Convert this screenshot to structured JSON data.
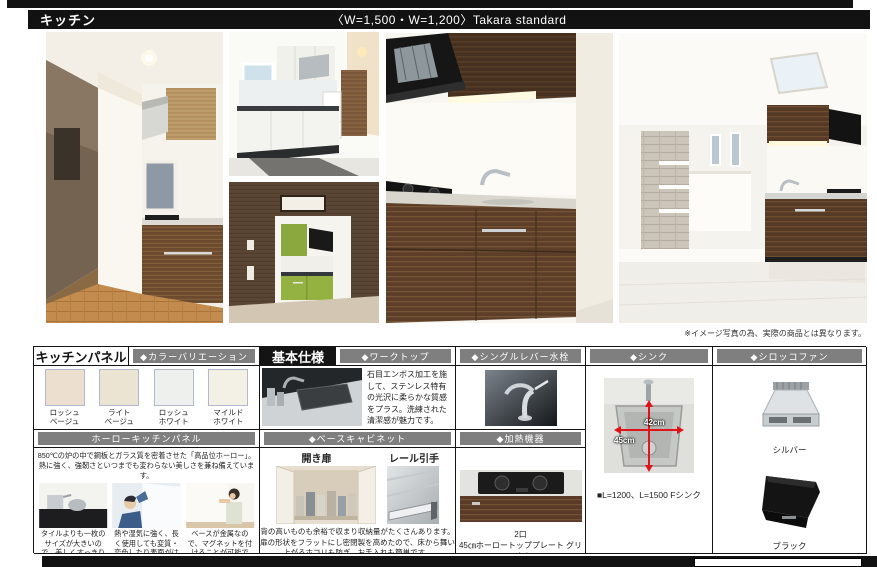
{
  "header": {
    "title": "キッチン",
    "subtitle": "〈W=1,500・W=1,200〉Takara standard"
  },
  "disclaimer": "※イメージ写真の為、実際の商品とは異なります。",
  "colors": {
    "header_bar": "#121212",
    "section_gray": "#7f7f7f",
    "dimension_red": "#e0131a"
  },
  "spec_table": {
    "kitchen_panel": {
      "title": "キッチンパネル",
      "color_variation_header": "◆カラーバリエーション",
      "swatches": [
        {
          "line1": "ロッシュ",
          "line2": "ベージュ",
          "color": "#eddfd0"
        },
        {
          "line1": "ライト",
          "line2": "ベージュ",
          "color": "#ebe4d2"
        },
        {
          "line1": "ロッシュ",
          "line2": "ホワイト",
          "color": "#edf0ec"
        },
        {
          "line1": "マイルド",
          "line2": "ホワイト",
          "color": "#f3f1e5"
        }
      ],
      "holo_header": "ホーローキッチンパネル",
      "holo_intro": "850℃の炉の中で鋼板とガラス質を密着させた「高品位ホーロー」。熱に強く、強靭さといつまでも変わらない美しさを兼ね備えています。",
      "features": [
        {
          "caption": "タイルよりも一枚のサイズが大きいので、美しくすっきりとした印象に。"
        },
        {
          "caption": "熱や湿気に強く、長く使用しても変質・変色したり表面がはがれたりしません。"
        },
        {
          "caption": "ベースが金属なので、マグネットを付けることが可能です。"
        }
      ]
    },
    "basic_spec": {
      "title": "基本仕様",
      "worktop_header": "◆ワークトップ",
      "worktop_text": "石目エンボス加工を施して、ステンレス特有の光沢に柔らかな質感をプラス。洗練された清潔感が魅力です。",
      "base_cabinet_header": "◆ベースキャビネット",
      "hinged_door_label": "開き扉",
      "rail_handle_label": "レール引手",
      "base_cabinet_text": "背の高いものも余裕で収まり収納量がたくさんあります。扉の形状をフラットにし密閉製を高めたので、床から舞い上がるホコリも防ぎ、お手入れも簡単です。"
    },
    "faucet": {
      "header": "◆シングルレバー水栓"
    },
    "heater": {
      "header": "◆加熱機器",
      "caption_line1": "2口",
      "caption_line2": "45㎝ホーロートッププレート グリルなし"
    },
    "sink": {
      "header": "◆シンク",
      "width_label": "42cm",
      "depth_label": "45cm",
      "caption": "■L=1200、L=1500 Fシンク"
    },
    "fan": {
      "header": "◆シロッコファン",
      "silver_label": "シルバー",
      "black_label": "ブラック"
    }
  }
}
